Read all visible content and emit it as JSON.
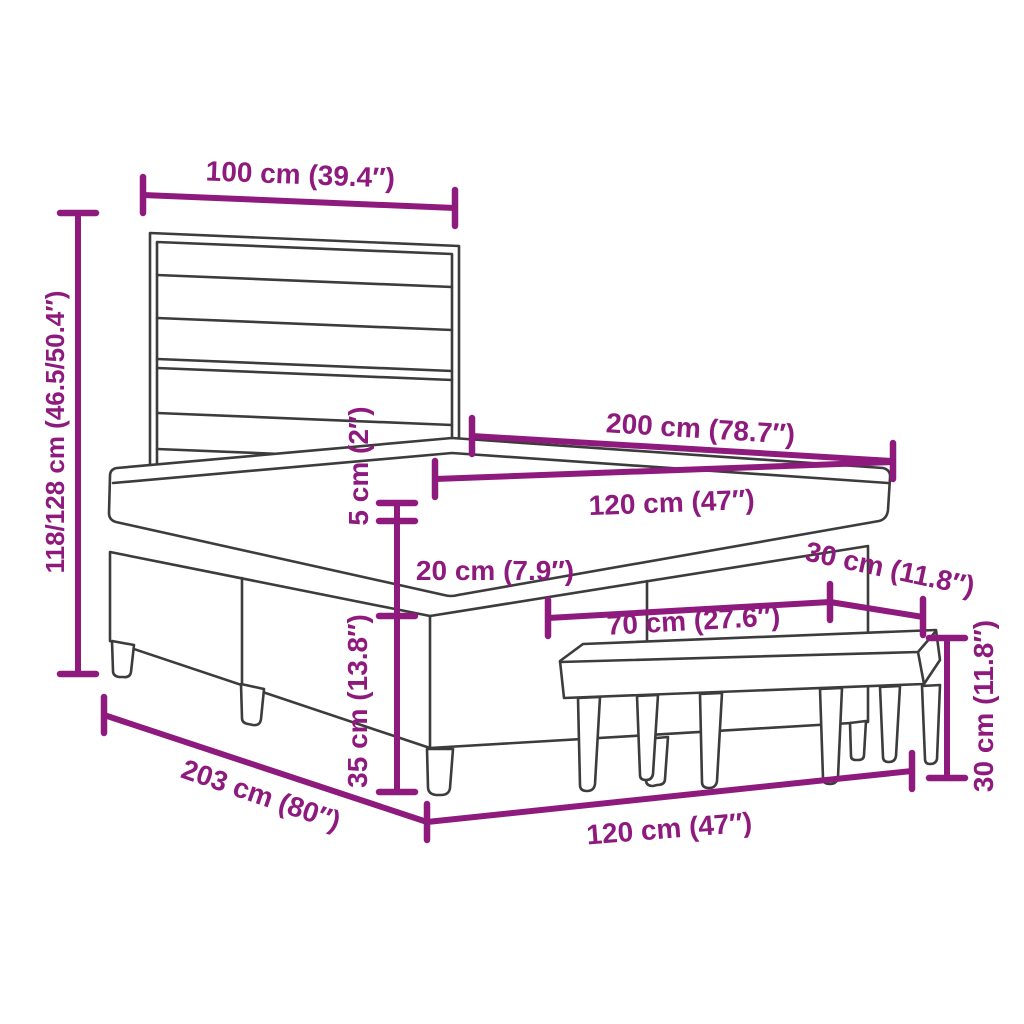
{
  "colors": {
    "dimension_annotation": "#8e1a7d",
    "line_art": "#3c3c3c",
    "background": "#ffffff"
  },
  "objects": [
    "box spring bed with slatted headboard",
    "upholstered bench at foot of bed"
  ],
  "dimensions": {
    "headboard_width": "100 cm (39.4″)",
    "headboard_height": "118/128 cm (46.5/50.4″)",
    "bed_length": "200 cm (78.7″)",
    "bed_width_top": "120 cm (47″)",
    "topper_thickness": "5 cm (2″)",
    "mattress_thickness": "20 cm (7.9″)",
    "base_height": "35 cm (13.8″)",
    "bench_depth": "30 cm (11.8″)",
    "bench_length": "70 cm (27.6″)",
    "bench_height": "30 cm (11.8″)",
    "frame_length": "203 cm (80″)",
    "frame_width_bottom": "120 cm (47″)"
  }
}
